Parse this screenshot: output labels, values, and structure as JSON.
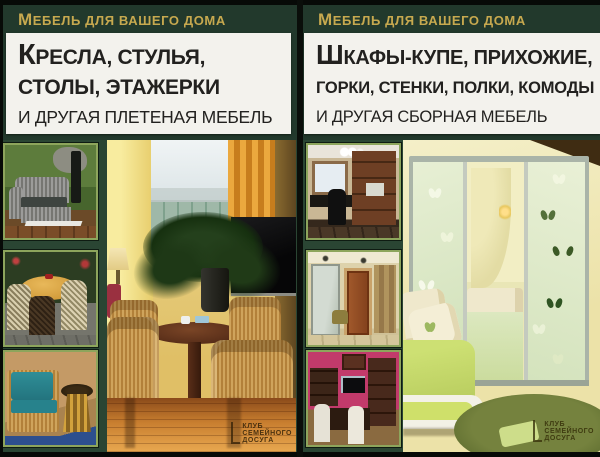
{
  "left_cover": {
    "series_label": "Мебель для вашего дома",
    "title_lines": [
      "Кресла, стулья,",
      "столы, этажерки",
      "и другая плетеная мебель"
    ],
    "publisher": [
      "Клуб",
      "семейного",
      "досуга"
    ],
    "photos": {
      "thumb_1": "плетеный диван в саду",
      "thumb_2": "круглый стол и плетеные стулья на террасе",
      "thumb_3": "плетеный диван с бирюзовыми подушками и столик",
      "main": "гостиная с плетеными креслами вокруг круглого стола"
    }
  },
  "right_cover": {
    "series_label": "Мебель для вашего дома",
    "title_lines": [
      "Шкафы-купе, прихожие,",
      "горки, стенки, полки, комоды",
      "и другая сборная мебель"
    ],
    "publisher": [
      "Клуб",
      "семейного",
      "досуга"
    ],
    "photos": {
      "thumb_1": "кабинет со сборными стеллажами",
      "thumb_2": "прихожая с зеркальным шкафом",
      "thumb_3": "комната со стенкой и обеденной группой",
      "main": "детская со шкафом-купе, украшенным бабочками"
    }
  },
  "colors": {
    "cover_background": "#22392c",
    "photo_area_background": "#2a4533",
    "series_text_gold": "#c7a94f",
    "title_box_background": "#f3f2ed",
    "title_text": "#22211f",
    "thumbnail_border": "#8da55c",
    "edge_black": "#070a07"
  }
}
